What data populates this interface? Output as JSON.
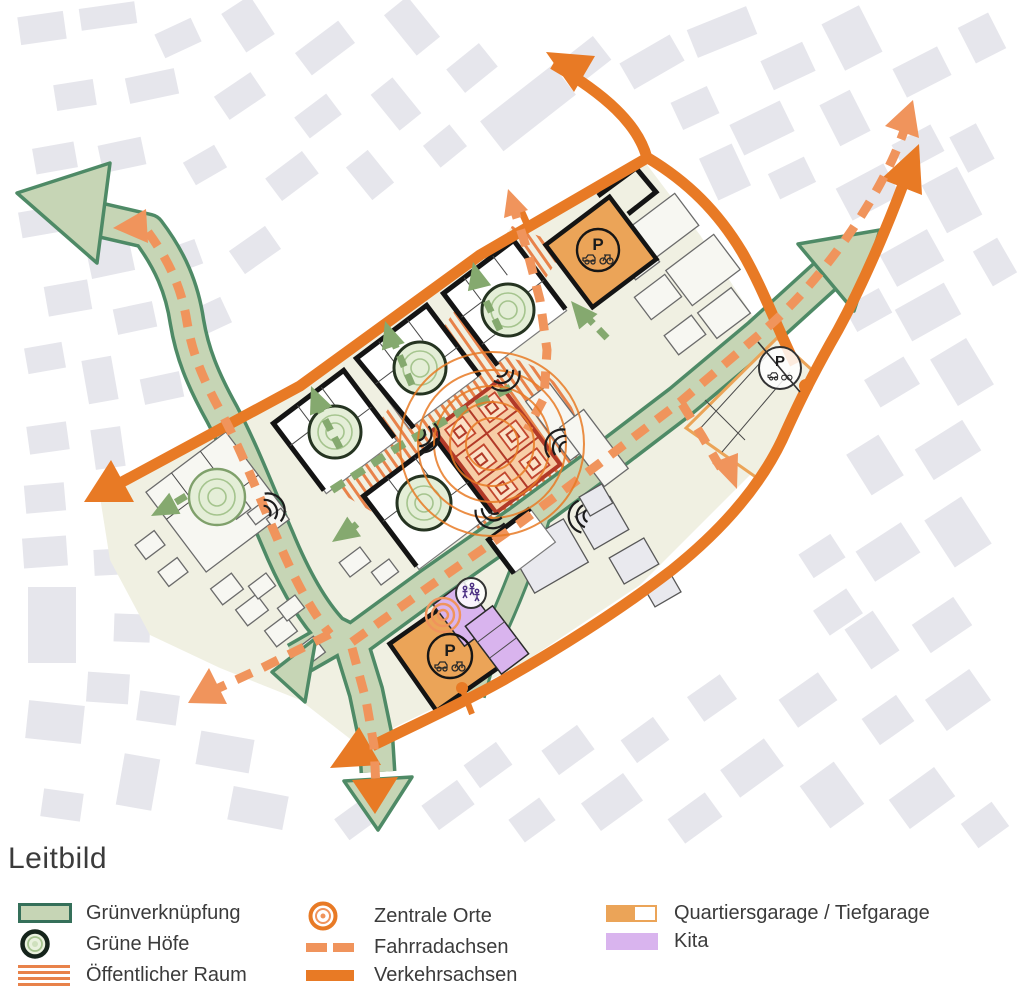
{
  "title": "Leitbild",
  "colors": {
    "orange": "#E87A25",
    "orange_light": "#F0945C",
    "green_band": "#C6D5B5",
    "green_dark": "#4E8A66",
    "green_dash": "#85A96F",
    "hatch_orange": "#E8824A",
    "site_cream": "#F0F0E2",
    "bldg_gray": "#E6E6EC",
    "garage_orange": "#EBA458",
    "kita_purple": "#D9B4EE",
    "market_red": "#B23A28",
    "market_fill": "#F7CDA6",
    "text_dark": "#3B3B3B"
  },
  "map": {
    "parking_label": "P"
  },
  "legend": {
    "columns": [
      {
        "items": [
          {
            "icon": "green-connection-swatch",
            "label": "Grünverknüpfung"
          },
          {
            "icon": "green-courtyard-icon",
            "label": "Grüne Höfe"
          },
          {
            "icon": "public-space-swatch",
            "label": "Öffentlicher Raum"
          }
        ]
      },
      {
        "items": [
          {
            "icon": "central-place-icon",
            "label": "Zentrale Orte"
          },
          {
            "icon": "bike-axis-swatch",
            "label": "Fahrradachsen"
          },
          {
            "icon": "traffic-axis-swatch",
            "label": "Verkehrsachsen"
          }
        ]
      },
      {
        "items": [
          {
            "icon": "garage-swatch",
            "label": "Quartiersgarage / Tiefgarage"
          },
          {
            "icon": "kita-swatch",
            "label": "Kita"
          }
        ]
      }
    ]
  }
}
